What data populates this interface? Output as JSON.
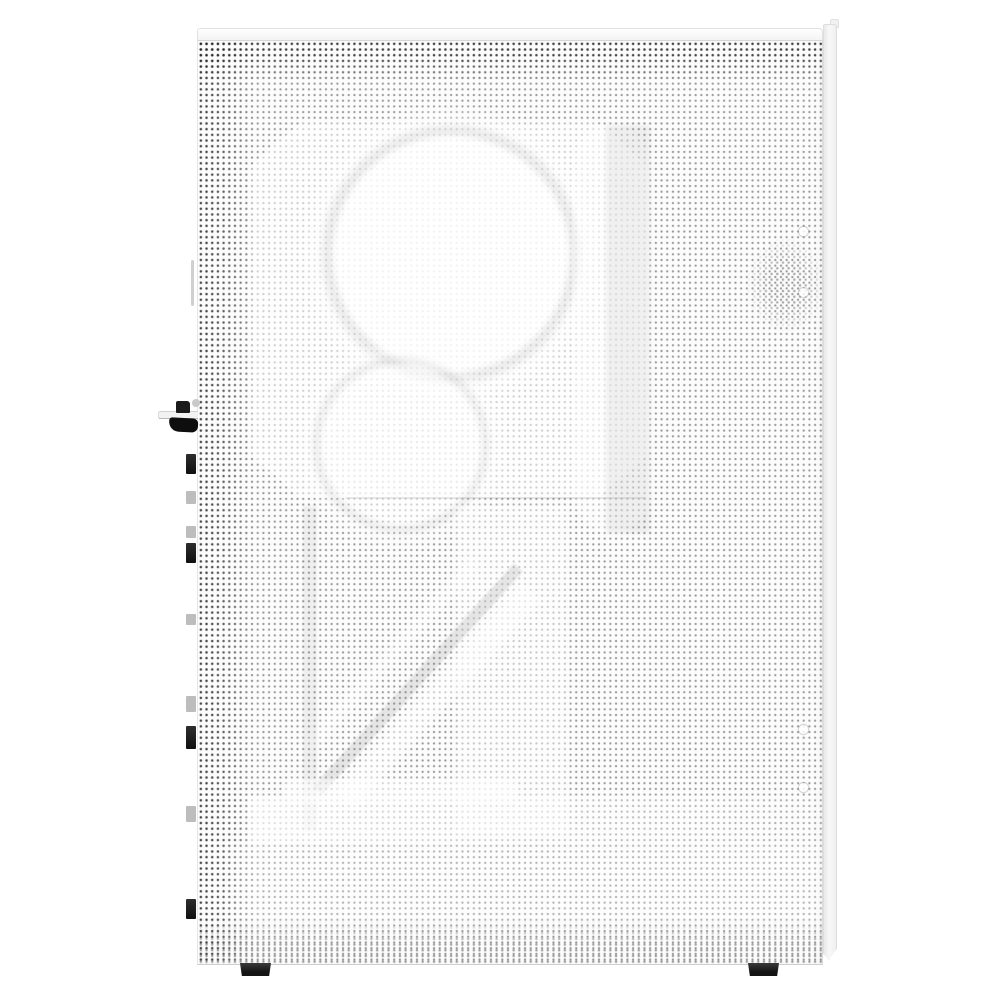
{
  "scene": {
    "type": "product-photo",
    "subject": "White PC tower case, side view, fully perforated mesh side panel",
    "background": "#ffffff"
  },
  "palette": {
    "case_white": "#fbfbfb",
    "mesh_dot_gray": "#5f5f5f",
    "mesh_dot_dark": "#161616",
    "edge_gray": "#dddddd",
    "hardware_black": "#141414",
    "hardware_gray": "#bdbdbd",
    "foot_black": "#1d1d1d"
  },
  "case_parts": {
    "top_cap": "top edge cap",
    "mesh_side_panel": "perforated mesh side panel",
    "front_edge_strip": "front bezel edge strip",
    "rear_latch": "side-panel release latch with black knob and grip",
    "rear_tab_count": 9,
    "rubber_feet_count": 2,
    "thumbscrew_hole_count": 4
  },
  "visible_internals": [
    "fan-frame-silhouette",
    "upper-fan-circle",
    "lower-fan-circle",
    "vertical-radiator-bar",
    "horizontal-divider-line",
    "diagonal-support-bracket",
    "psu-shroud-band",
    "lower-chamber-band"
  ],
  "hardware": {
    "rear_tabs": [
      {
        "y": 454,
        "h": 20,
        "tone": "dark"
      },
      {
        "y": 491,
        "h": 13,
        "tone": "gray"
      },
      {
        "y": 526,
        "h": 12,
        "tone": "gray"
      },
      {
        "y": 543,
        "h": 20,
        "tone": "dark"
      },
      {
        "y": 614,
        "h": 11,
        "tone": "gray"
      },
      {
        "y": 696,
        "h": 16,
        "tone": "gray"
      },
      {
        "y": 726,
        "h": 23,
        "tone": "dark"
      },
      {
        "y": 806,
        "h": 16,
        "tone": "gray"
      },
      {
        "y": 899,
        "h": 20,
        "tone": "dark"
      }
    ],
    "feet": [
      {
        "x": 240
      },
      {
        "x": 748
      }
    ]
  },
  "case_details": {
    "thumbscrew_hole_y": [
      227,
      288,
      725,
      783
    ]
  }
}
